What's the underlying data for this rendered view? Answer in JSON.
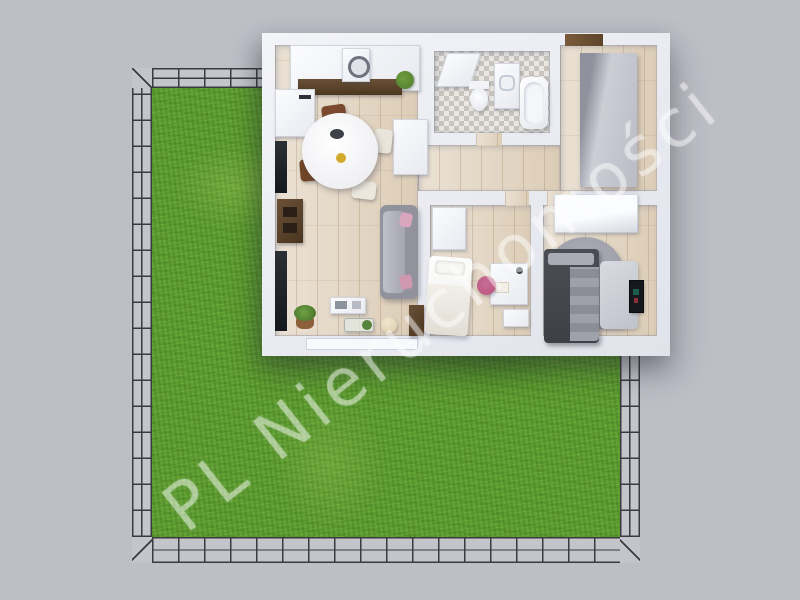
{
  "watermark": {
    "text": "PL Nieruchomości"
  },
  "colors": {
    "background": "#bdbec6",
    "grass": "#5f9e33",
    "fence_line": "#3a3b40",
    "fence_base": "#c4c5cb",
    "wall": "#eef0f6",
    "wood_floor": "#e3d6c3",
    "tile_floor": "#e9e7e2",
    "sofa_gray": "#92929d",
    "bed_dark": "#3e4046",
    "accent_pink": "#b9537f",
    "counter_brown": "#6a5036",
    "plant_green": "#4e7d2c"
  }
}
